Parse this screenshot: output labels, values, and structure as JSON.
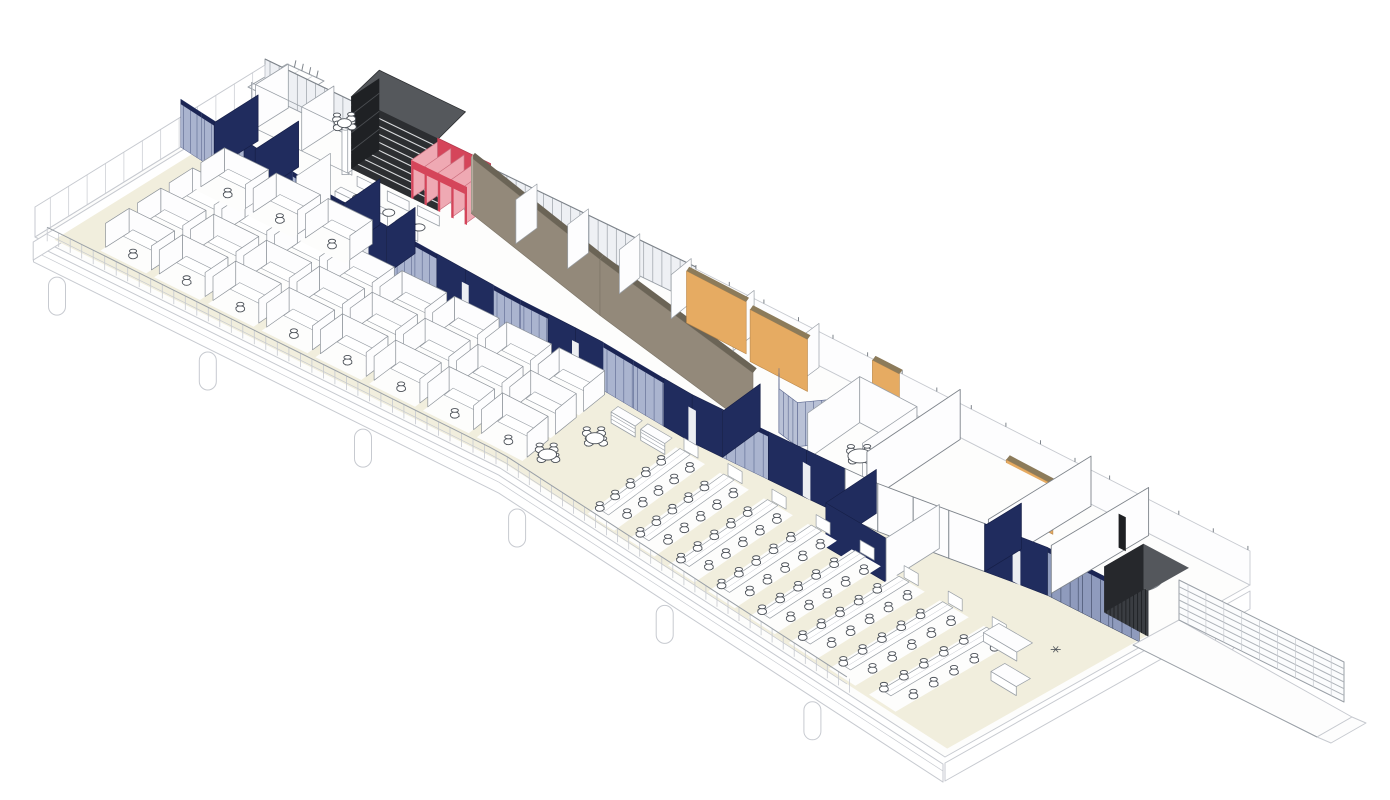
{
  "meta": {
    "title": "Axonometric cutaway drawing of an office floor plate with open cubicle areas, navy corridor partitions, feature walls and entry ramp",
    "drawing_type": "architectural axonometric floor plan",
    "background": "#ffffff"
  },
  "scene": {
    "patch": {
      "south": [
        [
          35,
          237
        ],
        [
          500,
          468
        ],
        [
          945,
          757
        ]
      ],
      "north": [
        [
          265,
          95
        ],
        [
          700,
          305
        ],
        [
          1250,
          585
        ]
      ],
      "length": 1050,
      "width": 300
    },
    "colors": {
      "navy": "#202c5e",
      "navyDark": "#161f47",
      "navyCap": "#1b2554",
      "glass": "#aab4cf",
      "glassDark": "#8f9bbd",
      "mullion": "#5c6890",
      "mullionDark": "#39445f",
      "cream": "#f1eedd",
      "floorWhite": "#fdfdfc",
      "taupe": "#93897a",
      "taupeTop": "#6b6456",
      "taupeEnd": "#b6ada0",
      "orange": "#e6ab62",
      "orangeTop": "#8c7b5a",
      "red": "#d5455a",
      "pink": "#efa9b3",
      "redDark": "#b03a4c",
      "louver": "#2c2e31",
      "louverTop": "#55585c",
      "louverLine": "#d8dadc",
      "wood": "#c2945c",
      "woodLine": "#8a6536",
      "line": "#9aa0a7",
      "lineLight": "#c7cad0",
      "lineMed": "#7e848b",
      "ink": "#4c5158",
      "white": "#ffffff",
      "slatDark": "#3a3d42",
      "slatLine": "#17191c",
      "slatTop": "#54575c"
    },
    "slabTop": [
      [
        0,
        0
      ],
      [
        0,
        300
      ],
      [
        525,
        300
      ],
      [
        1050,
        300
      ],
      [
        1050,
        0
      ],
      [
        525,
        0
      ]
    ],
    "fasciaDepth": [
      6,
      24
    ],
    "creamFloor": [
      [
        15,
        8
      ],
      [
        15,
        200
      ],
      [
        180,
        172
      ],
      [
        420,
        160
      ],
      [
        620,
        158
      ],
      [
        800,
        174
      ],
      [
        950,
        204
      ],
      [
        1043,
        208
      ],
      [
        1043,
        8
      ],
      [
        525,
        8
      ]
    ],
    "columnsSouth": [
      30,
      200,
      375,
      550,
      725,
      900
    ],
    "cornerPier": {
      "a": 1046,
      "b": 280
    },
    "interiorColumns": [
      [
        140,
        252
      ],
      [
        480,
        246
      ]
    ],
    "northGlaze": {
      "a1": 0,
      "a2": 520,
      "h": 36,
      "mullionStep": 11
    },
    "northWallEast": {
      "a1": 520,
      "a2": 1050,
      "h": 34,
      "tickStep": 33
    },
    "stub": {
      "quad": [
        [
          248,
          87
        ],
        [
          287,
          64
        ],
        [
          324,
          81
        ],
        [
          285,
          105
        ]
      ],
      "dots": [
        3,
        5
      ]
    },
    "spine": {
      "path": [
        [
          0,
          190
        ],
        [
          180,
          165
        ],
        [
          420,
          150
        ],
        [
          620,
          146
        ],
        [
          800,
          162
        ],
        [
          950,
          192
        ],
        [
          1045,
          196
        ]
      ],
      "height": 48,
      "segments": [
        [
          0,
          85,
          "glass"
        ],
        [
          85,
          150,
          "navy"
        ],
        [
          150,
          215,
          "glass"
        ],
        [
          215,
          268,
          "navy"
        ],
        [
          268,
          330,
          "glass"
        ],
        [
          330,
          400,
          "navy"
        ],
        [
          400,
          465,
          "glass"
        ],
        [
          465,
          530,
          "navy"
        ],
        [
          530,
          595,
          "glass"
        ],
        [
          595,
          655,
          "navy"
        ],
        [
          655,
          700,
          "glass"
        ],
        [
          700,
          775,
          "navy"
        ],
        [
          775,
          900,
          "white"
        ],
        [
          900,
          955,
          "navy"
        ],
        [
          955,
          1045,
          "glassdark"
        ]
      ]
    },
    "returns": [
      {
        "a": 45,
        "len": 58,
        "style": "navy"
      },
      {
        "a": 100,
        "len": 58,
        "style": "navy"
      },
      {
        "a": 155,
        "len": 46,
        "style": "white"
      },
      {
        "a": 215,
        "len": 50,
        "style": "navy"
      },
      {
        "a": 268,
        "len": 40,
        "style": "navy"
      },
      {
        "a": 655,
        "len": 50,
        "style": "navy"
      },
      {
        "a": 900,
        "len": 40,
        "style": "navy"
      }
    ],
    "westRoomWalls": [
      [
        30,
        255,
        298
      ],
      [
        85,
        255,
        298
      ],
      [
        140,
        255,
        298
      ]
    ],
    "louver": {
      "a1": 138,
      "a2": 242,
      "b": 262,
      "h": 72,
      "stripes": 8
    },
    "booths": {
      "aList": [
        160,
        196,
        232
      ],
      "b": 215,
      "depth": 30
    },
    "cafeTable": {
      "a": 85,
      "b": 312
    },
    "redStalls": {
      "a0": 210,
      "count": 4,
      "step": 16,
      "b1": 262,
      "b2": 298,
      "h": 38
    },
    "taupe": {
      "pts": [
        [
          268,
          278
        ],
        [
          460,
          232
        ],
        [
          650,
          196
        ]
      ],
      "h": 56
    },
    "roomDividersAboveTaupe": [
      330,
      392,
      454,
      516,
      578,
      640
    ],
    "orangePanels": [
      {
        "a1": 530,
        "a2": 588,
        "b": 272,
        "h": 52
      },
      {
        "a1": 596,
        "a2": 652,
        "b": 266,
        "h": 52
      },
      {
        "a1": 700,
        "a2": 726,
        "b": 286,
        "h": 46
      },
      {
        "a1": 858,
        "a2": 904,
        "b": 252,
        "h": 50,
        "window": true,
        "cabinets": true
      }
    ],
    "confCurve": {
      "pts": [
        [
          652,
          228
        ],
        [
          668,
          207
        ],
        [
          690,
          203
        ],
        [
          706,
          224
        ]
      ],
      "h": 44
    },
    "meetingRoom": {
      "a1": 706,
      "a2": 762,
      "b1": 196,
      "b2": 262,
      "h": 46,
      "table": [
        733,
        228
      ]
    },
    "whiteRoom": {
      "a1": 775,
      "a2": 900,
      "b1": 186,
      "b2": 298,
      "h": 50
    },
    "navySouthRoom": {
      "a1": 790,
      "a2": 855,
      "b1": 120,
      "b2": 180,
      "h": 44
    },
    "neWall": {
      "a": 955,
      "b1": 196,
      "b2": 298,
      "h": 48
    },
    "slatPanel": {
      "a": 950,
      "b": 272,
      "h": 34
    },
    "spiralStair": {
      "a": 988,
      "b": 252,
      "rx": 25,
      "ry": 14,
      "spokes": 18
    },
    "vestibule": {
      "a1": 1000,
      "a2": 1045,
      "b": 205,
      "bTop": 245,
      "h": 46
    },
    "ramp": {
      "deck": [
        [
          1133,
          645
        ],
        [
          1317,
          737
        ],
        [
          1352,
          717
        ],
        [
          1179,
          620
        ]
      ],
      "rail": {
        "p1": [
          1179,
          620
        ],
        "p2": [
          1344,
          702
        ],
        "h": 40,
        "lines": 5,
        "postStep": 20
      },
      "tip": [
        [
          1317,
          737
        ],
        [
          1352,
          717
        ],
        [
          1366,
          723
        ],
        [
          1331,
          743
        ]
      ]
    },
    "cubicleFieldA": {
      "a0": 55,
      "step": 61,
      "cols": 8,
      "rows": [
        22,
        64,
        106
      ],
      "extraRow": 148,
      "extraCols": 3,
      "cw": 52,
      "cd": 38,
      "panelH": 24
    },
    "benchField": {
      "a0": 628,
      "step": 47,
      "count": 8,
      "b1": 16,
      "b2": 126,
      "chairStep": 21,
      "chairs": 5
    },
    "shelves": [
      [
        385,
        124
      ],
      [
        417,
        124
      ],
      [
        449,
        124
      ],
      [
        560,
        118
      ],
      [
        592,
        118
      ]
    ],
    "roundTables": [
      [
        545,
        45
      ],
      [
        562,
        92
      ]
    ],
    "sofasEast": [
      [
        962,
        118,
        36,
        16
      ],
      [
        1002,
        88,
        28,
        14
      ]
    ],
    "railSouth": {
      "a1": 12,
      "a2": 945,
      "postStep": 13,
      "h": 14
    }
  }
}
